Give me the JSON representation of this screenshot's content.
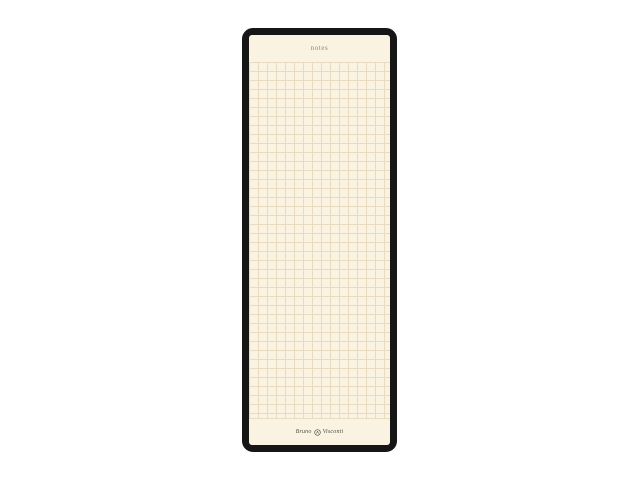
{
  "page": {
    "background_color": "#ffffff"
  },
  "notepad": {
    "frame_color": "#161616",
    "paper_color": "#faf3e2",
    "grid_line_color": "#e8dbc0",
    "header": {
      "title": "notes",
      "title_color": "#8d8578"
    },
    "footer": {
      "brand_left": "Bruno",
      "brand_right": "Visconti",
      "emblem_icon": "round-crest-icon",
      "brand_color": "#4c5247"
    }
  }
}
